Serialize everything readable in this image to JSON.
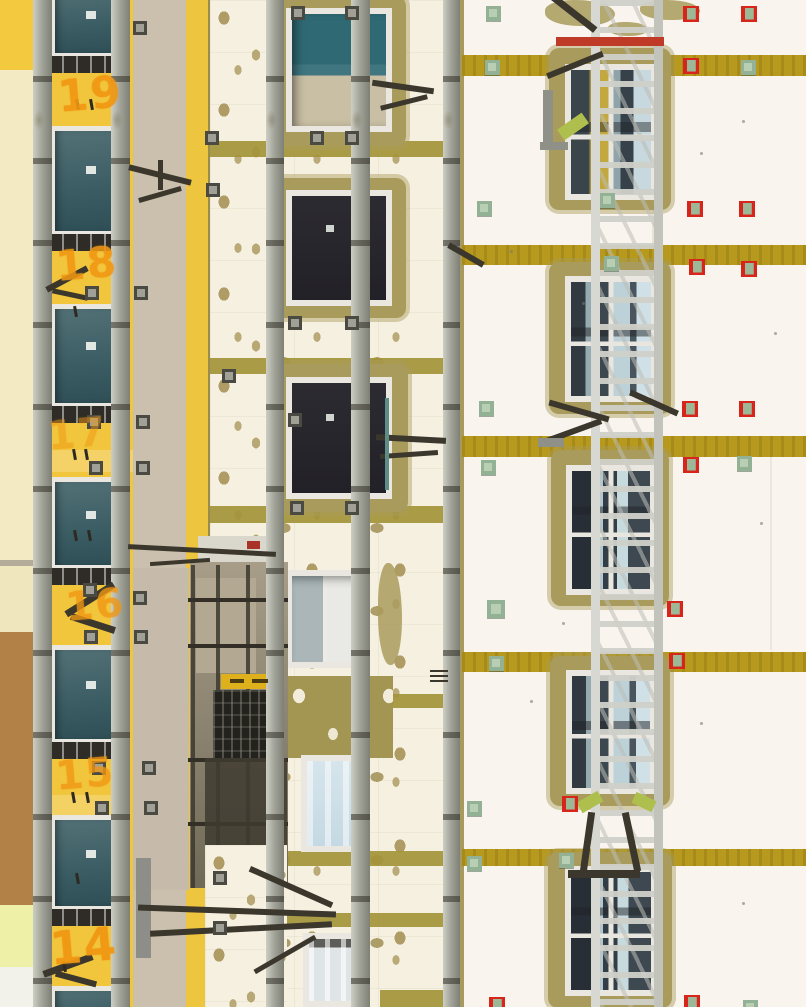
{
  "meta": {
    "type": "photograph",
    "description": "Telephoto view of a high-rise apartment facade during thermal renovation: yellow painted section with windows and scaffold rails on the left, white EPS insulation wall with adhesive mortar dabs and mortar-framed windows in the centre, finished white wall with mustard mineral-wool fire-break stripes, red and green anchor markers and a full-height aluminium hoist mast on the right."
  },
  "palette": {
    "yellow": "#f1c63d",
    "paleCream": "#f3e9c3",
    "beige": "#cbbfae",
    "brown": "#b18147",
    "whiteDab": "#f6f0e1",
    "dab": "#b19d67",
    "rightWhite": "#f9f5ee",
    "stripe": "#b7991d",
    "band": "#a3943a",
    "mortar": "#a99b5c",
    "red": "#d8251b",
    "green": "#9cbc9e",
    "plate": "#4a4a42",
    "orange": "#f09712",
    "galv": "#a8aa9e",
    "mast": "#cfd0c8",
    "darkHw": "#3b372c"
  },
  "floor_numbers": [
    {
      "label": "19",
      "x": 58,
      "y": 68,
      "size": 44,
      "opacity": 0.92
    },
    {
      "label": "18",
      "x": 56,
      "y": 238,
      "size": 42,
      "opacity": 0.88
    },
    {
      "label": "17",
      "x": 48,
      "y": 410,
      "size": 40,
      "opacity": 0.5
    },
    {
      "label": "16",
      "x": 66,
      "y": 581,
      "size": 40,
      "opacity": 0.8
    },
    {
      "label": "15",
      "x": 56,
      "y": 750,
      "size": 40,
      "opacity": 0.8
    },
    {
      "label": "14",
      "x": 50,
      "y": 918,
      "size": 46,
      "opacity": 0.95
    }
  ],
  "zones": [
    {
      "name": "right-facade-wall",
      "x": 0,
      "y": 0,
      "w": 806,
      "h": 1007,
      "c": "#f9f5ee"
    },
    {
      "name": "far-left-wall-top",
      "x": 0,
      "y": 0,
      "w": 33,
      "h": 70,
      "c": "#f2c93f"
    },
    {
      "name": "far-left-wall",
      "x": 0,
      "y": 70,
      "w": 33,
      "h": 492,
      "c": "#f3e9c3"
    },
    {
      "name": "far-left-ledge",
      "x": 0,
      "y": 560,
      "w": 33,
      "h": 6,
      "c": "#b4ac99"
    },
    {
      "name": "far-left-wall-mid",
      "x": 0,
      "y": 566,
      "w": 33,
      "h": 66,
      "c": "#efe6bd"
    },
    {
      "name": "far-left-brown-patch",
      "x": 0,
      "y": 632,
      "w": 33,
      "h": 273,
      "c": "#b18147"
    },
    {
      "name": "far-left-wall-low",
      "x": 0,
      "y": 905,
      "w": 33,
      "h": 62,
      "c": "#eef0a8"
    },
    {
      "name": "far-left-wall-bottom",
      "x": 0,
      "y": 967,
      "w": 33,
      "h": 40,
      "c": "#f2f2ea"
    },
    {
      "name": "yellow-facade",
      "x": 33,
      "y": 0,
      "w": 100,
      "h": 1007,
      "c": "#f1c63d"
    },
    {
      "name": "yellow-floor-band",
      "x": 33,
      "y": 450,
      "w": 100,
      "h": 22,
      "c": "rgba(255,255,255,0.22)"
    },
    {
      "name": "yellow-floor-band",
      "x": 33,
      "y": 795,
      "w": 100,
      "h": 20,
      "c": "rgba(255,255,255,0.2)"
    },
    {
      "name": "beige-strip",
      "x": 133,
      "y": 0,
      "w": 53,
      "h": 1007,
      "c": "#cbbfae"
    },
    {
      "name": "yellow-stripe",
      "x": 186,
      "y": 0,
      "w": 24,
      "h": 1007,
      "c": "#eec53e"
    },
    {
      "name": "yellow-stripe-edge",
      "x": 208,
      "y": 0,
      "w": 4,
      "h": 1007,
      "c": "#9a8c4a"
    },
    {
      "name": "yellow-patch-lower",
      "x": 130,
      "y": 753,
      "w": 52,
      "h": 112,
      "c": "#f1c63d"
    },
    {
      "name": "beige-under-balcony",
      "x": 133,
      "y": 568,
      "w": 56,
      "h": 322,
      "c": "#c6bbaa"
    },
    {
      "name": "insulation-wall",
      "x": 210,
      "y": 0,
      "w": 242,
      "h": 1007,
      "c": "#f6f0e1",
      "cls": "dabs"
    },
    {
      "name": "corner-mortar-strip",
      "x": 451,
      "y": 0,
      "w": 13,
      "h": 1007,
      "c": "#a89a5e"
    },
    {
      "name": "facade-seam",
      "x": 652,
      "y": 60,
      "w": 2,
      "h": 190,
      "c": "rgba(140,130,90,0.15)"
    },
    {
      "name": "facade-seam",
      "x": 770,
      "y": 440,
      "w": 2,
      "h": 210,
      "c": "rgba(140,130,90,0.12)"
    }
  ],
  "right_stripes": {
    "x": 462,
    "w": 344,
    "c": "#b7991d",
    "rows": [
      {
        "y": 55,
        "h": 21
      },
      {
        "y": 245,
        "h": 20
      },
      {
        "y": 436,
        "h": 21
      },
      {
        "y": 652,
        "h": 20
      },
      {
        "y": 849,
        "h": 17
      }
    ]
  },
  "middle_bands": {
    "c": "#a3943a",
    "rows": [
      {
        "x": 210,
        "w": 241,
        "y": 141,
        "h": 16
      },
      {
        "x": 210,
        "w": 241,
        "y": 358,
        "h": 16
      },
      {
        "x": 210,
        "w": 241,
        "y": 506,
        "h": 17
      },
      {
        "x": 380,
        "w": 72,
        "y": 694,
        "h": 14
      },
      {
        "x": 286,
        "w": 165,
        "y": 851,
        "h": 15
      },
      {
        "x": 286,
        "w": 165,
        "y": 913,
        "h": 14
      },
      {
        "x": 380,
        "w": 72,
        "y": 990,
        "h": 17
      }
    ]
  },
  "mortar_patches": [
    {
      "x": 545,
      "y": 0,
      "w": 70,
      "h": 26
    },
    {
      "x": 640,
      "y": 0,
      "w": 60,
      "h": 20
    },
    {
      "x": 608,
      "y": 22,
      "w": 40,
      "h": 14
    },
    {
      "x": 378,
      "y": 563,
      "w": 24,
      "h": 102
    }
  ],
  "bare_panel": {
    "x": 283,
    "y": 676,
    "w": 110,
    "h": 82,
    "c": "#a39552"
  },
  "windows": {
    "left": {
      "x": 50,
      "w": 70,
      "rows": [
        {
          "y": -16,
          "h": 78
        },
        {
          "y": 126,
          "h": 114
        },
        {
          "y": 304,
          "h": 108
        },
        {
          "y": 477,
          "h": 97
        },
        {
          "y": 645,
          "h": 103
        },
        {
          "y": 815,
          "h": 100
        },
        {
          "y": 986,
          "h": 60
        }
      ]
    },
    "middle": [
      {
        "mx": 272,
        "my": -4,
        "mw": 134,
        "mh": 150,
        "fx": 286,
        "fy": 8,
        "fw": 106,
        "fh": 124,
        "glass": "g-tc"
      },
      {
        "mx": 272,
        "my": 178,
        "mw": 134,
        "mh": 140,
        "fx": 286,
        "fy": 190,
        "fw": 106,
        "fh": 116,
        "glass": "g-dk"
      },
      {
        "mx": 270,
        "my": 364,
        "mw": 138,
        "mh": 148,
        "fx": 286,
        "fy": 377,
        "fw": 106,
        "fh": 122,
        "glass": "g-dk"
      },
      {
        "fx": 286,
        "fy": 570,
        "fw": 78,
        "fh": 98,
        "glass": "g-ow"
      },
      {
        "fx": 301,
        "fy": 755,
        "fw": 64,
        "fh": 97,
        "glass": "g-lb"
      },
      {
        "fx": 303,
        "fy": 933,
        "fw": 62,
        "fh": 74,
        "glass": "g-cu"
      }
    ],
    "right": [
      {
        "mx": 549,
        "my": 48,
        "mw": 122,
        "mh": 162,
        "fx": 565,
        "fy": 64,
        "fw": 92,
        "fh": 136,
        "glass": "g-ry"
      },
      {
        "mx": 549,
        "my": 262,
        "mw": 122,
        "mh": 152,
        "fx": 565,
        "fy": 276,
        "fw": 92,
        "fh": 126,
        "glass": "g-ra"
      },
      {
        "mx": 551,
        "my": 450,
        "mw": 118,
        "mh": 156,
        "fx": 566,
        "fy": 465,
        "fw": 90,
        "fh": 130,
        "glass": "g-rb"
      },
      {
        "mx": 550,
        "my": 656,
        "mw": 120,
        "mh": 150,
        "fx": 566,
        "fy": 670,
        "fw": 90,
        "fh": 124,
        "glass": "g-ra"
      },
      {
        "mx": 548,
        "my": 852,
        "mw": 124,
        "mh": 156,
        "fx": 565,
        "fy": 866,
        "fw": 92,
        "fh": 130,
        "glass": "g-rb"
      }
    ]
  },
  "balcony": [
    {
      "name": "balcony-slab",
      "x": 198,
      "y": 536,
      "w": 78,
      "h": 28,
      "c": "#dad7cd"
    },
    {
      "name": "balcony-slab-shadow",
      "x": 190,
      "y": 562,
      "w": 98,
      "h": 16,
      "c": "#55503f"
    },
    {
      "name": "balcony-recess",
      "x": 190,
      "y": 562,
      "w": 98,
      "h": 326,
      "c": "linear-gradient(180deg,#a79d88,#6f6a57)"
    },
    {
      "name": "balcony-back-wall",
      "x": 196,
      "y": 578,
      "w": 60,
      "h": 95,
      "c": "#b3a992"
    },
    {
      "name": "scaffold-tube",
      "x": 191,
      "y": 565,
      "w": 4,
      "h": 323,
      "c": "rgba(60,56,46,0.85)"
    },
    {
      "name": "scaffold-tube",
      "x": 216,
      "y": 565,
      "w": 4,
      "h": 323,
      "c": "rgba(60,56,46,0.85)"
    },
    {
      "name": "scaffold-tube",
      "x": 246,
      "y": 565,
      "w": 4,
      "h": 323,
      "c": "rgba(60,56,46,0.85)"
    },
    {
      "name": "scaffold-tube",
      "x": 188,
      "y": 598,
      "w": 100,
      "h": 4,
      "c": "#332f26"
    },
    {
      "name": "scaffold-tube",
      "x": 188,
      "y": 644,
      "w": 100,
      "h": 4,
      "c": "#332f26"
    },
    {
      "name": "scaffold-tube",
      "x": 188,
      "y": 758,
      "w": 100,
      "h": 4,
      "c": "#332f26"
    },
    {
      "name": "scaffold-tube",
      "x": 188,
      "y": 822,
      "w": 100,
      "h": 4,
      "c": "#332f26"
    },
    {
      "name": "warning-plank",
      "x": 221,
      "y": 674,
      "w": 56,
      "h": 15,
      "c": "#ddb01c"
    },
    {
      "name": "platform-deck",
      "x": 213,
      "y": 690,
      "w": 66,
      "h": 68,
      "c": "#23221c",
      "cls": "platgrid"
    },
    {
      "name": "balcony-lower-dark",
      "x": 205,
      "y": 758,
      "w": 82,
      "h": 126,
      "c": "rgba(63,59,48,0.85)"
    },
    {
      "name": "insulation-patch",
      "x": 205,
      "y": 845,
      "w": 82,
      "h": 162,
      "c": "#f6f0e1",
      "cls": "dabs"
    },
    {
      "name": "platform-rail-bar",
      "x": 136,
      "y": 858,
      "w": 15,
      "h": 100,
      "c": "#8e8e88"
    }
  ],
  "scaffold": {
    "posts": [
      {
        "x": 33,
        "w": 19
      },
      {
        "x": 111,
        "w": 19
      },
      {
        "x": 266,
        "w": 18
      },
      {
        "x": 351,
        "w": 19
      },
      {
        "x": 443,
        "w": 17
      }
    ],
    "mast": {
      "x": 591,
      "w": 54
    }
  },
  "hardware": [
    {
      "x": 128,
      "y": 172,
      "w": 64,
      "h": 6,
      "a": 14
    },
    {
      "x": 138,
      "y": 192,
      "w": 44,
      "h": 5,
      "a": -16
    },
    {
      "x": 158,
      "y": 160,
      "w": 5,
      "h": 30,
      "a": 0
    },
    {
      "x": 44,
      "y": 276,
      "w": 46,
      "h": 6,
      "a": -28
    },
    {
      "x": 52,
      "y": 292,
      "w": 36,
      "h": 5,
      "a": 12
    },
    {
      "x": 372,
      "y": 84,
      "w": 62,
      "h": 6,
      "a": 8
    },
    {
      "x": 380,
      "y": 100,
      "w": 48,
      "h": 5,
      "a": -14
    },
    {
      "x": 376,
      "y": 436,
      "w": 70,
      "h": 6,
      "a": 3
    },
    {
      "x": 380,
      "y": 452,
      "w": 58,
      "h": 5,
      "a": -4
    },
    {
      "x": 385,
      "y": 398,
      "w": 4,
      "h": 92,
      "a": 0,
      "c": "#5e8c86"
    },
    {
      "x": 62,
      "y": 596,
      "w": 56,
      "h": 7,
      "a": -32
    },
    {
      "x": 70,
      "y": 620,
      "w": 46,
      "h": 7,
      "a": 18
    },
    {
      "x": 446,
      "y": 252,
      "w": 40,
      "h": 6,
      "a": 30
    },
    {
      "x": 430,
      "y": 670,
      "w": 18,
      "h": 2,
      "a": 0
    },
    {
      "x": 430,
      "y": 675,
      "w": 18,
      "h": 2,
      "a": 0
    },
    {
      "x": 430,
      "y": 680,
      "w": 18,
      "h": 2,
      "a": 0
    },
    {
      "x": 128,
      "y": 548,
      "w": 148,
      "h": 5,
      "a": 3
    },
    {
      "x": 150,
      "y": 560,
      "w": 60,
      "h": 4,
      "a": -4
    },
    {
      "x": 247,
      "y": 541,
      "w": 13,
      "h": 8,
      "a": 0,
      "c": "#a93326"
    },
    {
      "x": 230,
      "y": 679,
      "w": 14,
      "h": 4,
      "a": 0,
      "c": "#4a3c10"
    },
    {
      "x": 252,
      "y": 679,
      "w": 16,
      "h": 4,
      "a": 0,
      "c": "#4a3c10"
    },
    {
      "x": 138,
      "y": 908,
      "w": 198,
      "h": 6,
      "a": 2
    },
    {
      "x": 150,
      "y": 926,
      "w": 182,
      "h": 6,
      "a": -3
    },
    {
      "x": 246,
      "y": 884,
      "w": 90,
      "h": 6,
      "a": 24
    },
    {
      "x": 250,
      "y": 952,
      "w": 70,
      "h": 5,
      "a": -30
    },
    {
      "x": 42,
      "y": 962,
      "w": 52,
      "h": 7,
      "a": -20
    },
    {
      "x": 55,
      "y": 976,
      "w": 42,
      "h": 6,
      "a": 15
    },
    {
      "x": 547,
      "y": 10,
      "w": 54,
      "h": 7,
      "a": 38
    },
    {
      "x": 545,
      "y": 62,
      "w": 60,
      "h": 6,
      "a": -22
    },
    {
      "x": 556,
      "y": 37,
      "w": 108,
      "h": 9,
      "a": 0,
      "c": "#c03a28"
    },
    {
      "x": 543,
      "y": 90,
      "w": 10,
      "h": 56,
      "a": 0,
      "c": "#8f9188"
    },
    {
      "x": 558,
      "y": 120,
      "w": 30,
      "h": 13,
      "a": -35,
      "c": "#aebf4e"
    },
    {
      "x": 540,
      "y": 142,
      "w": 28,
      "h": 8,
      "a": 0,
      "c": "#8f9188"
    },
    {
      "x": 548,
      "y": 408,
      "w": 62,
      "h": 6,
      "a": 16
    },
    {
      "x": 545,
      "y": 428,
      "w": 58,
      "h": 6,
      "a": -20
    },
    {
      "x": 628,
      "y": 400,
      "w": 52,
      "h": 6,
      "a": 24
    },
    {
      "x": 538,
      "y": 438,
      "w": 26,
      "h": 9,
      "a": 0,
      "c": "#8f9188"
    },
    {
      "x": 578,
      "y": 796,
      "w": 24,
      "h": 12,
      "a": -30,
      "c": "#aebf4e"
    },
    {
      "x": 633,
      "y": 796,
      "w": 22,
      "h": 12,
      "a": 25,
      "c": "#aebf4e"
    },
    {
      "x": 584,
      "y": 812,
      "w": 7,
      "h": 60,
      "a": 8
    },
    {
      "x": 628,
      "y": 812,
      "w": 7,
      "h": 60,
      "a": -12
    },
    {
      "x": 568,
      "y": 870,
      "w": 72,
      "h": 8,
      "a": 0
    }
  ],
  "markers": {
    "red": [
      [
        683,
        6
      ],
      [
        741,
        6
      ],
      [
        683,
        58
      ],
      [
        687,
        201
      ],
      [
        739,
        201
      ],
      [
        689,
        259
      ],
      [
        741,
        261
      ],
      [
        682,
        401
      ],
      [
        739,
        401
      ],
      [
        683,
        457
      ],
      [
        667,
        601
      ],
      [
        669,
        653
      ],
      [
        562,
        796
      ],
      [
        684,
        995
      ],
      [
        489,
        997
      ]
    ],
    "green": [
      [
        486,
        6
      ],
      [
        485,
        60
      ],
      [
        741,
        60
      ],
      [
        477,
        201
      ],
      [
        600,
        193
      ],
      [
        604,
        256
      ],
      [
        479,
        401
      ],
      [
        481,
        460
      ],
      [
        737,
        456
      ],
      [
        487,
        600,
        18
      ],
      [
        489,
        656
      ],
      [
        467,
        801
      ],
      [
        467,
        856
      ],
      [
        559,
        853
      ],
      [
        743,
        1000
      ]
    ]
  },
  "anchor_plates": [
    [
      291,
      6
    ],
    [
      345,
      6
    ],
    [
      133,
      21
    ],
    [
      205,
      131
    ],
    [
      310,
      131
    ],
    [
      345,
      131
    ],
    [
      206,
      183
    ],
    [
      85,
      286
    ],
    [
      134,
      286
    ],
    [
      288,
      316
    ],
    [
      345,
      316
    ],
    [
      222,
      369
    ],
    [
      87,
      415
    ],
    [
      136,
      415
    ],
    [
      288,
      413
    ],
    [
      89,
      461
    ],
    [
      136,
      461
    ],
    [
      290,
      501
    ],
    [
      345,
      501
    ],
    [
      83,
      583
    ],
    [
      133,
      591
    ],
    [
      84,
      630
    ],
    [
      134,
      630
    ],
    [
      92,
      761
    ],
    [
      142,
      761
    ],
    [
      95,
      801
    ],
    [
      144,
      801
    ],
    [
      213,
      871
    ],
    [
      213,
      921
    ]
  ],
  "ticks": [
    [
      76,
      99
    ],
    [
      90,
      99
    ],
    [
      74,
      306
    ],
    [
      73,
      449
    ],
    [
      85,
      449
    ],
    [
      74,
      530
    ],
    [
      88,
      530
    ],
    [
      72,
      792
    ],
    [
      86,
      792
    ],
    [
      76,
      873
    ],
    [
      63,
      961
    ]
  ],
  "specks": [
    [
      742,
      120
    ],
    [
      700,
      152
    ],
    [
      774,
      332
    ],
    [
      562,
      622
    ],
    [
      760,
      522
    ],
    [
      700,
      722
    ],
    [
      582,
      302
    ],
    [
      742,
      902
    ],
    [
      510,
      250
    ],
    [
      530,
      700
    ]
  ]
}
